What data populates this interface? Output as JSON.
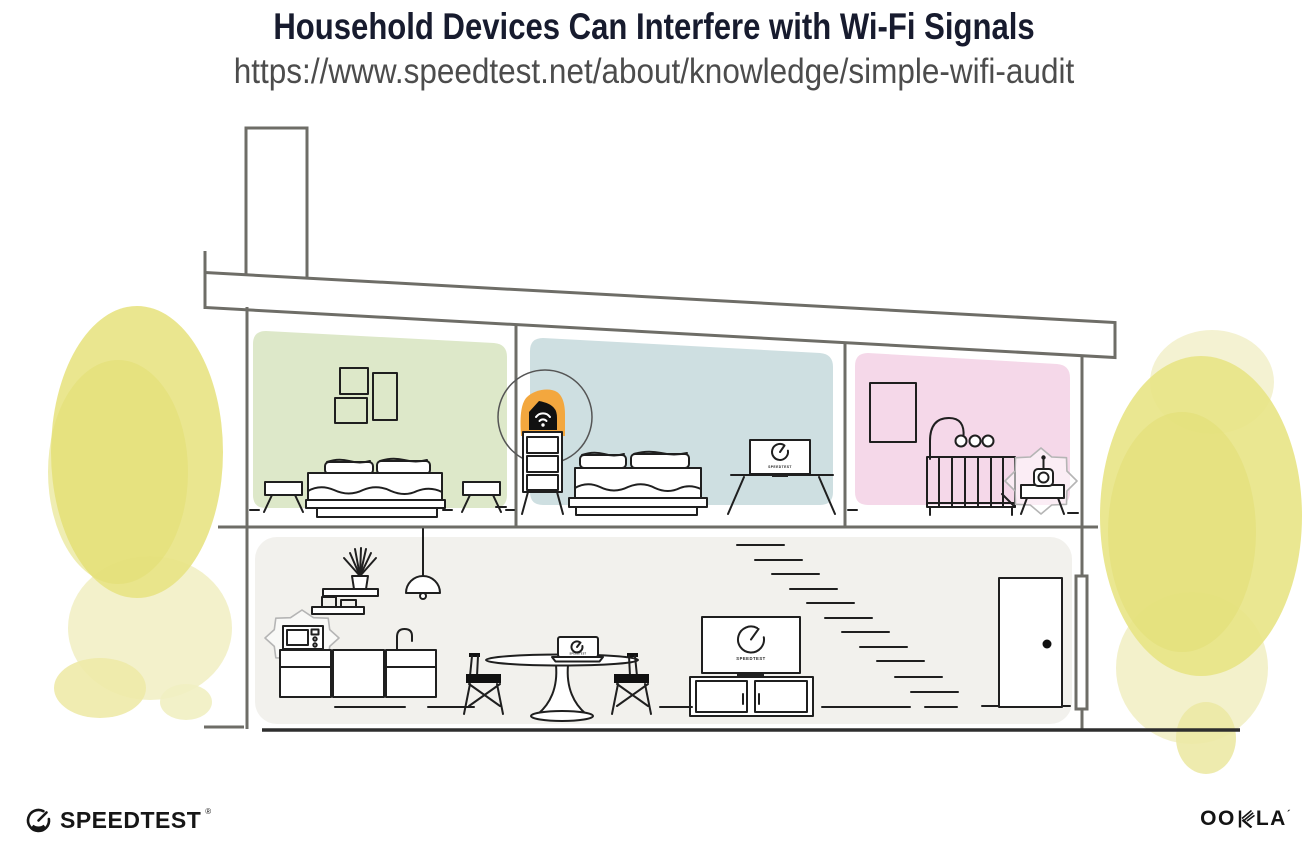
{
  "header": {
    "title": "Household Devices Can Interfere with Wi-Fi Signals",
    "url": "https://www.speedtest.net/about/knowledge/simple-wifi-audit"
  },
  "illustration": {
    "screens": {
      "tv_label": "SPEEDTEST",
      "monitor_label": "SPEEDTEST",
      "laptop_label": "SPEEDTEST"
    },
    "icons": [
      "wifi-router-icon",
      "speedtest-gauge-icon",
      "interference-burst-icon",
      "pendant-lamp-icon"
    ]
  },
  "footer": {
    "speedtest": {
      "text": "SPEEDTEST",
      "mark": "®"
    },
    "ookla": {
      "text": "OOKLA",
      "left": "OO",
      "right": "LA",
      "mark": "´"
    }
  },
  "theme": {
    "title_color": "#171b2e",
    "url_color": "#4c4c4c",
    "ink": "#1f1f1f",
    "structure_gray": "#6e6d67",
    "room_green": "#dde8c9",
    "room_blue": "#cedfe1",
    "room_pink": "#f5d8e9",
    "room_lower": "#f2f1ed",
    "router_orange": "#f3a73e",
    "tree_yellow": "#e8e485",
    "tree_yellow_dark": "#e2de72",
    "tree_yellow_light": "#f1efc2",
    "interference_gray": "#b5b5b5"
  }
}
